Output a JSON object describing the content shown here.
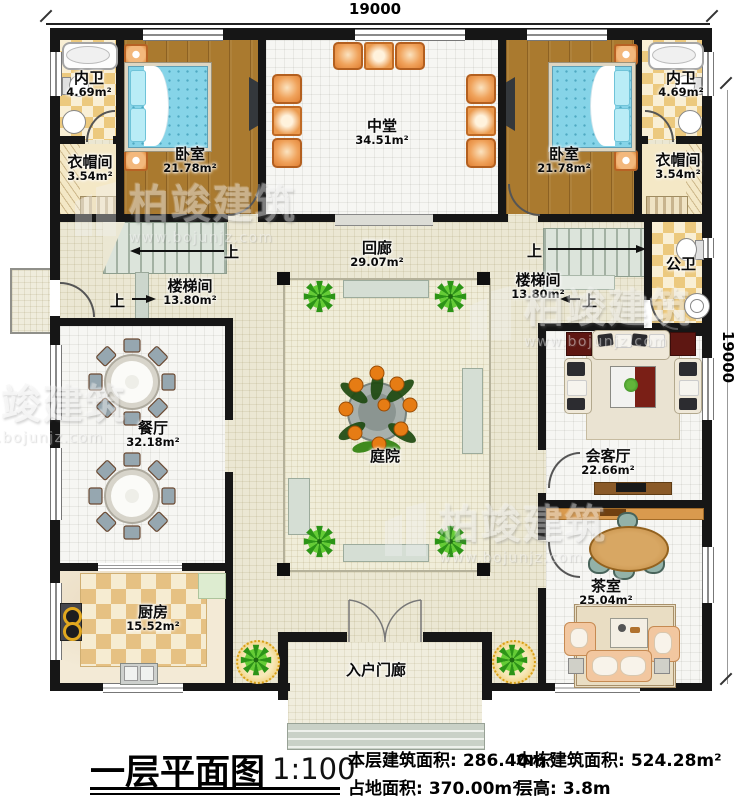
{
  "dimensions": {
    "top": "19000",
    "right": "19000"
  },
  "rooms": {
    "neiwei_left": {
      "name": "内卫",
      "area": "4.69m²"
    },
    "yimaojian_left": {
      "name": "衣帽间",
      "area": "3.54m²"
    },
    "woshi_left": {
      "name": "卧室",
      "area": "21.78m²"
    },
    "zhongtang": {
      "name": "中堂",
      "area": "34.51m²"
    },
    "woshi_right": {
      "name": "卧室",
      "area": "21.78m²"
    },
    "neiwei_right": {
      "name": "内卫",
      "area": "4.69m²"
    },
    "yimaojian_right": {
      "name": "衣帽间",
      "area": "3.54m²"
    },
    "huilang": {
      "name": "回廊",
      "area": "29.07m²"
    },
    "loutijian_left": {
      "name": "楼梯间",
      "area": "13.80m²"
    },
    "loutijian_right": {
      "name": "楼梯间",
      "area": "13.80m²"
    },
    "gongwei": {
      "name": "公卫"
    },
    "canting": {
      "name": "餐厅",
      "area": "32.18m²"
    },
    "tingyuan": {
      "name": "庭院"
    },
    "huiketing": {
      "name": "会客厅",
      "area": "22.66m²"
    },
    "chashi": {
      "name": "茶室",
      "area": "25.04m²"
    },
    "chufang": {
      "name": "厨房",
      "area": "15.52m²"
    },
    "ruhumenlang": {
      "name": "入户门廊"
    }
  },
  "stair_label": "上",
  "footer": {
    "title": "一层平面图",
    "scale": "1:100",
    "stats": [
      {
        "label": "本层建筑面积:",
        "value": "286.40m²"
      },
      {
        "label": "占地面积:",
        "value": "370.00m²"
      },
      {
        "label": "本栋建筑面积:",
        "value": "524.28m²"
      },
      {
        "label": "层高:",
        "value": "3.8m"
      }
    ]
  },
  "watermark": {
    "brand": "柏竣建筑",
    "url": "www.bojunjz.com"
  }
}
